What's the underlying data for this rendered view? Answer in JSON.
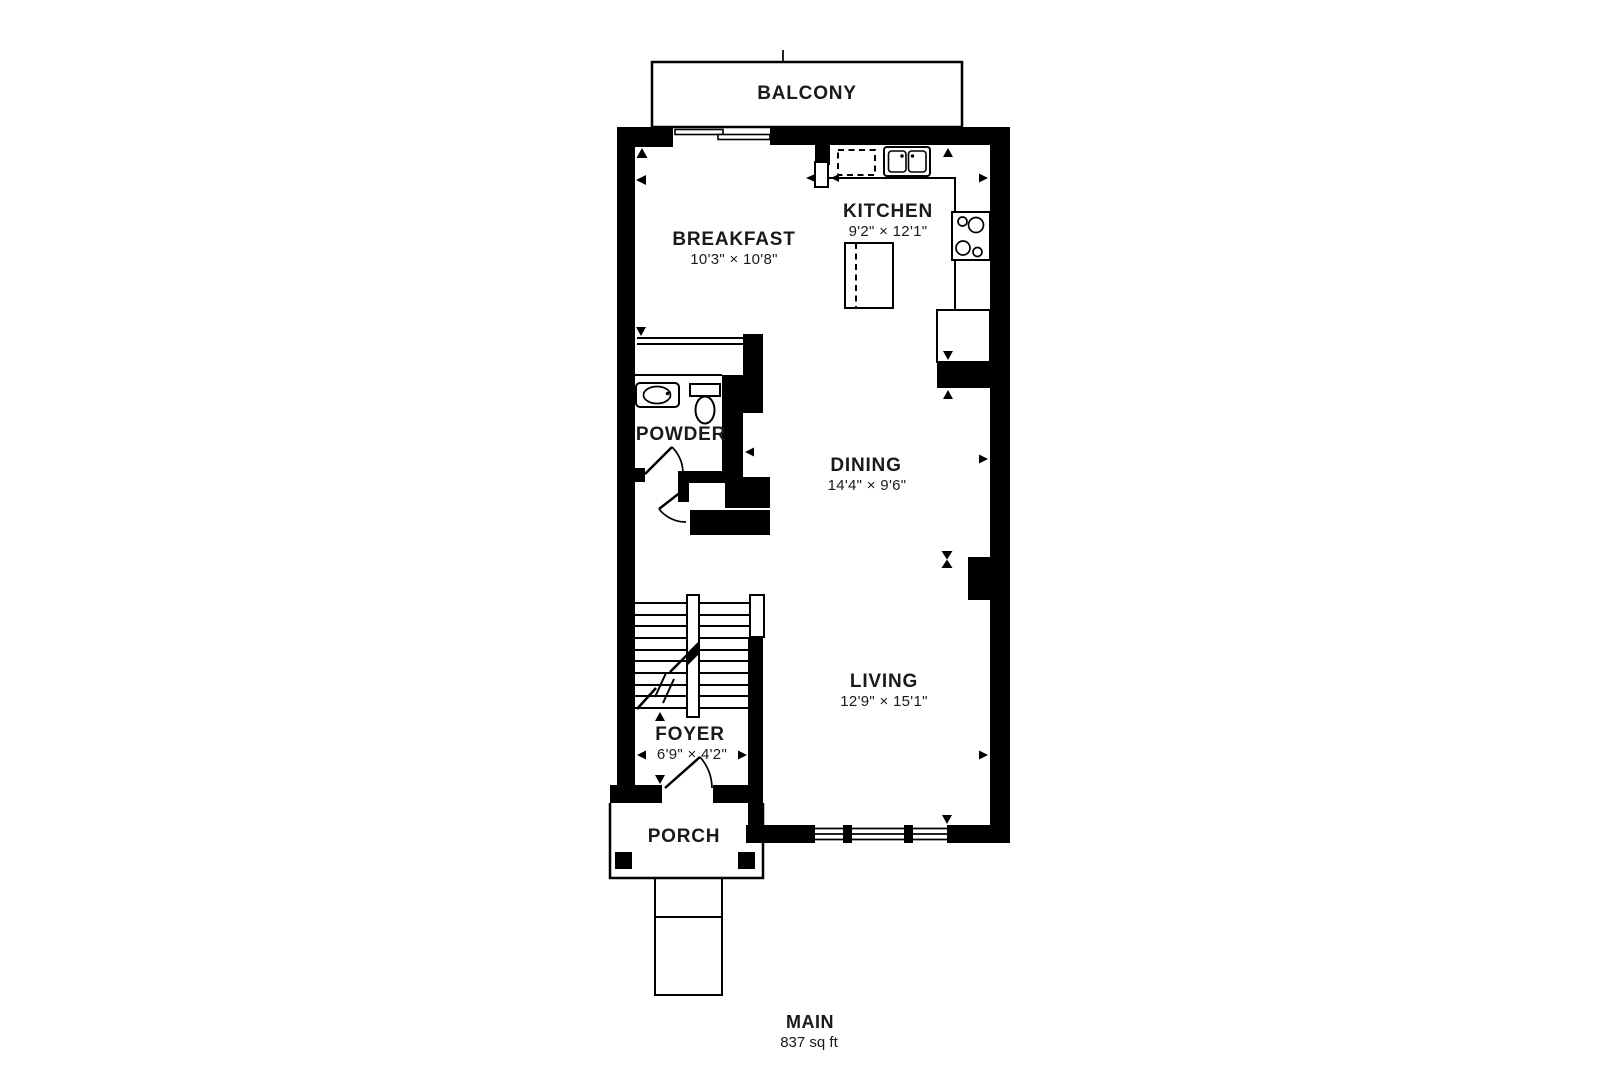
{
  "floorplan": {
    "balcony_label": "BALCONY",
    "rooms": {
      "breakfast": {
        "name": "BREAKFAST",
        "dims": "10'3\" × 10'8\""
      },
      "kitchen": {
        "name": "KITCHEN",
        "dims": "9'2\" × 12'1\""
      },
      "powder": {
        "name": "POWDER"
      },
      "dining": {
        "name": "DINING",
        "dims": "14'4\" × 9'6\""
      },
      "living": {
        "name": "LIVING",
        "dims": "12'9\" × 15'1\""
      },
      "foyer": {
        "name": "FOYER",
        "dims": "6'9\" × 4'2\""
      },
      "porch": {
        "name": "PORCH"
      }
    },
    "floor": {
      "name": "MAIN",
      "area": "837 sq ft"
    },
    "fixtures": [
      "balcony-sliding-door",
      "dishwasher",
      "double-basin-sink",
      "four-burner-cooktop",
      "refrigerator",
      "kitchen-island",
      "vanity-sink",
      "toilet",
      "staircase-up",
      "entry-door",
      "porch-pillars",
      "front-walkway"
    ],
    "colors": {
      "wall": "#000000",
      "text": "#1a1a1a",
      "bg": "#ffffff"
    }
  }
}
